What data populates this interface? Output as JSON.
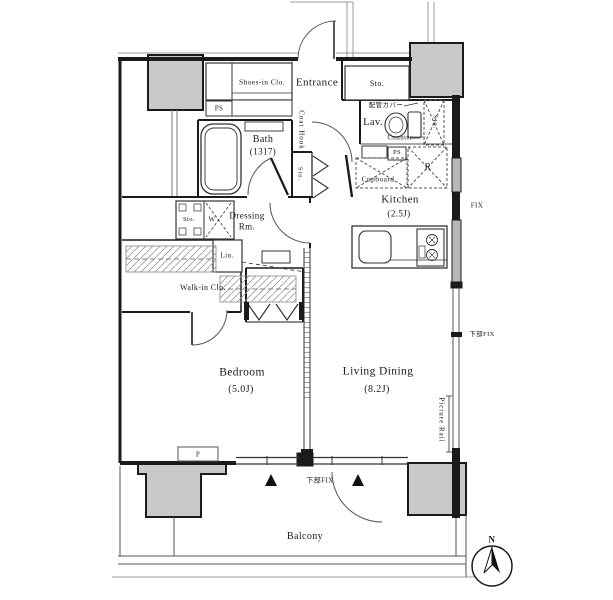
{
  "plan": {
    "labels": {
      "shoes_in_closet": "Shoes-in Clo.",
      "entrance": "Entrance",
      "storage_top": "Sto.",
      "ps_top": "PS",
      "coat_hook": "Coat Hook",
      "bath": "Bath",
      "bath_size": "(1317)",
      "lavatory": "Lav.",
      "pipe_cover": "配管カバー",
      "counter": "Counter",
      "storage_lavatory": "Sto.",
      "ps_kitchen": "PS",
      "refrigerator": "R",
      "cupboard": "Cupboard",
      "kitchen": "Kitchen",
      "kitchen_size": "(2.5J)",
      "storage_hall": "Sto.",
      "dressing_room_1": "Dressing",
      "dressing_room_2": "Rm.",
      "storage_washer": "Sto.",
      "washer": "W",
      "linen": "Lin.",
      "walk_in_closet": "Walk-in Clo.",
      "bedroom": "Bedroom",
      "bedroom_size": "(5.0J)",
      "living_dining": "Living Dining",
      "living_dining_size": "(8.2J)",
      "pipe_space": "P",
      "balcony": "Balcony"
    },
    "annotations": {
      "fix": "FIX",
      "lower_fix_right": "下部FIX",
      "lower_fix_bottom": "下部FIX",
      "picture_rail": "Picture Rail",
      "north": "N"
    },
    "colors": {
      "wall": "#1b1b1b",
      "column_fill": "#c9c9c9",
      "window_fill": "#b7b7b7"
    }
  }
}
